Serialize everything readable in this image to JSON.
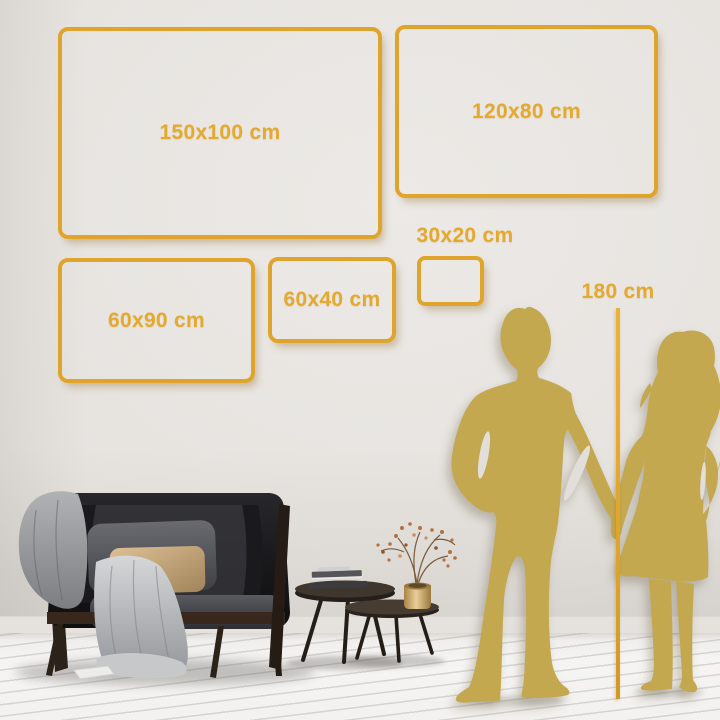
{
  "scene": {
    "name": "wall-art-size-guide",
    "reference_height_label": "180 cm"
  },
  "size_frames": [
    {
      "id": "150x100",
      "label": "150x100 cm"
    },
    {
      "id": "120x80",
      "label": "120x80 cm"
    },
    {
      "id": "60x90",
      "label": "60x90 cm"
    },
    {
      "id": "60x40",
      "label": "60x40 cm"
    },
    {
      "id": "30x20",
      "label": "30x20 cm"
    }
  ],
  "illustrations": {
    "couple": [
      "man-silhouette",
      "woman-silhouette"
    ],
    "room": [
      "sofa",
      "gray-blanket",
      "front-blanket",
      "gray-pillow",
      "tan-pillow",
      "coffee-table-large",
      "coffee-table-small",
      "books-stack",
      "brass-vase",
      "dried-branch",
      "wood-floor"
    ]
  },
  "colors": {
    "frame_gold": "#DFA42C",
    "label_gold": "#E4A92F",
    "silhouette_gold": "#C3A84F",
    "wall_gap": "#E2DEDA"
  }
}
